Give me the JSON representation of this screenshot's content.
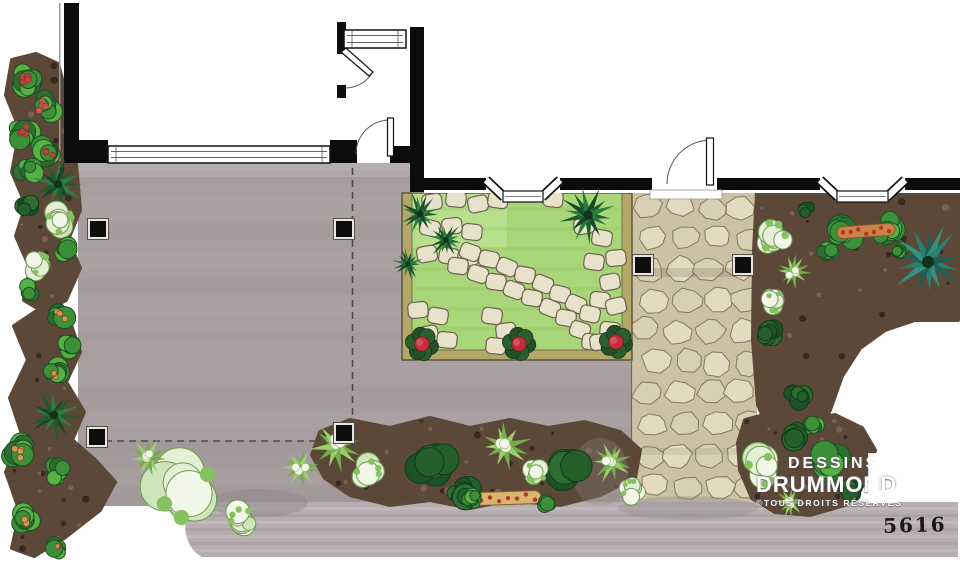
{
  "meta": {
    "plan_number": "5616"
  },
  "branding": {
    "line1": "DESSINS",
    "line2": "DRUMMOND",
    "line3": "©TOUS DROITS RÉSERVÉS",
    "logo_icon": "drummond-d-icon"
  },
  "palette": {
    "wall": "#0c0c0c",
    "patio": "#a79ea0",
    "patioLight": "#c2b9bb",
    "patioDark": "#948b8d",
    "strip": "#b6aeb1",
    "stripLight": "#c8c0c3",
    "stripDark": "#a29a9d",
    "grass": "#a8d678",
    "grassDark": "#8fc45e",
    "grassLight": "#c6e79f",
    "frame": "#b3a76a",
    "frameLine": "#4f4a35",
    "flagBg": "#cdc1a4",
    "flag1": "#e3dac1",
    "flag2": "#d9cfb2",
    "flagLine": "#837860",
    "stone": "#e9e2cb",
    "stoneLine": "#6d6550",
    "mulch": "#5c4838",
    "mulchDark": "#33261d",
    "mulchLight": "#7d6551",
    "g1": "#56b044",
    "g2": "#3b9038",
    "g3": "#2b6e30",
    "gdark": "#1d4e24",
    "shadow": "#8f8689",
    "white": "#ffffff"
  },
  "scene": {
    "patio_path": "M78,163 L412,163 L412,193 L402,193 L402,360 L631,360 L631,506 L78,506 Z",
    "strip_path": "M196,502 Q181,520 187,538 Q191,551 202,557 L958,557 L958,502 Z",
    "flagstone": {
      "x": 632,
      "y": 193,
      "w": 125,
      "h": 313
    },
    "grass": {
      "x": 412,
      "y": 193,
      "w": 210,
      "h": 157
    },
    "mulch_blobs": [
      [
        [
          12,
          60
        ],
        [
          36,
          54
        ],
        [
          58,
          64
        ],
        [
          64,
          86
        ],
        [
          64,
          150
        ],
        [
          76,
          164
        ],
        [
          80,
          210
        ],
        [
          68,
          240
        ],
        [
          80,
          268
        ],
        [
          66,
          300
        ],
        [
          44,
          312
        ],
        [
          24,
          300
        ],
        [
          30,
          268
        ],
        [
          16,
          236
        ],
        [
          26,
          205
        ],
        [
          12,
          172
        ],
        [
          20,
          130
        ],
        [
          6,
          95
        ]
      ],
      [
        [
          44,
          306
        ],
        [
          70,
          322
        ],
        [
          80,
          352
        ],
        [
          66,
          382
        ],
        [
          84,
          412
        ],
        [
          72,
          440
        ],
        [
          95,
          460
        ],
        [
          115,
          482
        ],
        [
          100,
          510
        ],
        [
          64,
          538
        ],
        [
          34,
          556
        ],
        [
          12,
          548
        ],
        [
          20,
          512
        ],
        [
          6,
          472
        ],
        [
          22,
          434
        ],
        [
          10,
          398
        ],
        [
          28,
          360
        ],
        [
          14,
          326
        ]
      ],
      [
        [
          757,
          193
        ],
        [
          958,
          193
        ],
        [
          958,
          320
        ],
        [
          915,
          320
        ],
        [
          885,
          330
        ],
        [
          860,
          348
        ],
        [
          842,
          376
        ],
        [
          830,
          410
        ],
        [
          815,
          440
        ],
        [
          795,
          450
        ],
        [
          772,
          438
        ],
        [
          758,
          405
        ],
        [
          753,
          340
        ],
        [
          754,
          250
        ]
      ],
      [
        [
          320,
          432
        ],
        [
          350,
          420
        ],
        [
          390,
          428
        ],
        [
          430,
          418
        ],
        [
          470,
          428
        ],
        [
          510,
          420
        ],
        [
          548,
          428
        ],
        [
          585,
          422
        ],
        [
          620,
          432
        ],
        [
          640,
          450
        ],
        [
          635,
          478
        ],
        [
          600,
          495
        ],
        [
          560,
          505
        ],
        [
          510,
          500
        ],
        [
          470,
          508
        ],
        [
          430,
          500
        ],
        [
          390,
          505
        ],
        [
          350,
          495
        ],
        [
          325,
          478
        ],
        [
          312,
          455
        ]
      ],
      [
        [
          745,
          420
        ],
        [
          775,
          412
        ],
        [
          805,
          420
        ],
        [
          835,
          415
        ],
        [
          862,
          428
        ],
        [
          875,
          450
        ],
        [
          868,
          480
        ],
        [
          845,
          505
        ],
        [
          810,
          515
        ],
        [
          775,
          512
        ],
        [
          752,
          498
        ],
        [
          740,
          470
        ],
        [
          738,
          443
        ]
      ]
    ],
    "shadows": [
      {
        "x": 258,
        "y": 503,
        "rx": 50,
        "ry": 14,
        "o": 0.45
      },
      {
        "x": 600,
        "y": 472,
        "rx": 28,
        "ry": 34,
        "o": 0.3
      },
      {
        "x": 688,
        "y": 508,
        "rx": 70,
        "ry": 12,
        "o": 0.35
      }
    ],
    "stepping_stones": [
      [
        432,
        202,
        -8
      ],
      [
        456,
        199,
        6
      ],
      [
        478,
        204,
        -12
      ],
      [
        498,
        200,
        8
      ],
      [
        430,
        228,
        14
      ],
      [
        452,
        226,
        -6
      ],
      [
        472,
        232,
        6
      ],
      [
        427,
        254,
        -10
      ],
      [
        449,
        256,
        10
      ],
      [
        468,
        258,
        -4
      ],
      [
        553,
        199,
        6
      ],
      [
        584,
        226,
        -8
      ],
      [
        602,
        238,
        10
      ],
      [
        616,
        258,
        -6
      ],
      [
        594,
        262,
        8
      ],
      [
        610,
        282,
        -10
      ],
      [
        600,
        300,
        6
      ],
      [
        616,
        306,
        -14
      ],
      [
        470,
        252,
        20
      ],
      [
        489,
        259,
        12
      ],
      [
        507,
        267,
        24
      ],
      [
        525,
        275,
        10
      ],
      [
        543,
        284,
        22
      ],
      [
        560,
        294,
        14
      ],
      [
        576,
        304,
        24
      ],
      [
        590,
        314,
        12
      ],
      [
        458,
        266,
        8
      ],
      [
        478,
        274,
        18
      ],
      [
        496,
        282,
        8
      ],
      [
        514,
        290,
        20
      ],
      [
        532,
        298,
        10
      ],
      [
        550,
        308,
        22
      ],
      [
        566,
        318,
        10
      ],
      [
        580,
        330,
        18
      ],
      [
        592,
        342,
        8
      ],
      [
        418,
        310,
        -6
      ],
      [
        438,
        316,
        10
      ],
      [
        428,
        334,
        -12
      ],
      [
        447,
        340,
        6
      ],
      [
        420,
        345,
        -4
      ],
      [
        492,
        316,
        8
      ],
      [
        506,
        331,
        -8
      ],
      [
        496,
        346,
        6
      ],
      [
        610,
        330,
        6
      ],
      [
        600,
        342,
        -6
      ]
    ],
    "dashed_lines": [
      {
        "x1": 352.5,
        "y1": 168,
        "x2": 352.5,
        "y2": 425
      },
      {
        "x1": 105,
        "y1": 441,
        "x2": 336,
        "y2": 441
      }
    ],
    "walls": [
      [
        64,
        3,
        15,
        160
      ],
      [
        64,
        140,
        44,
        23
      ],
      [
        330,
        140,
        27,
        23
      ],
      [
        390,
        146,
        22,
        17
      ],
      [
        337,
        22,
        9,
        32
      ],
      [
        337,
        85,
        9,
        13
      ],
      [
        410,
        27,
        14,
        165
      ],
      [
        424,
        178,
        62,
        12
      ],
      [
        560,
        178,
        92,
        12
      ],
      [
        717,
        178,
        103,
        12
      ],
      [
        905,
        178,
        55,
        12
      ]
    ],
    "windows": [
      {
        "x": 108,
        "y": 146,
        "w": 222,
        "h": 17
      },
      {
        "x": 344,
        "y": 30,
        "w": 62,
        "h": 18
      }
    ],
    "bays": [
      {
        "x1": 486,
        "x2": 560
      },
      {
        "x1": 820,
        "x2": 905
      }
    ],
    "doors": [
      {
        "arc": "M356,154 A34,34 0 0 1 390,120",
        "leaf": [
          387.5,
          118,
          6,
          38
        ]
      },
      {
        "arc": "M345,88 A33,33 0 0 0 371,75",
        "leaf_poly": "M341,52 L346,48 L373,72 L369,76 Z"
      },
      {
        "arc": "M667,184 A44,44 0 0 1 709,140",
        "leaf": [
          706.5,
          138,
          7,
          47
        ],
        "threshold": [
          650,
          190,
          72,
          9
        ]
      }
    ],
    "posts": [
      [
        90,
        221
      ],
      [
        336,
        221
      ],
      [
        89,
        429
      ],
      [
        336,
        425
      ],
      [
        635,
        257
      ],
      [
        735,
        257
      ]
    ],
    "post_size": 16,
    "plants": [
      {
        "t": "shrub",
        "x": 28,
        "y": 80,
        "r": 20,
        "f": "#b5463c"
      },
      {
        "t": "shrub",
        "x": 46,
        "y": 106,
        "r": 19,
        "f": "#c05a50"
      },
      {
        "t": "shrub",
        "x": 22,
        "y": 132,
        "r": 18,
        "f": "#b5463c"
      },
      {
        "t": "shrub",
        "x": 46,
        "y": 152,
        "r": 17,
        "f": "#b5463c"
      },
      {
        "t": "shrub",
        "x": 28,
        "y": 172,
        "r": 15
      },
      {
        "t": "palm",
        "x": 58,
        "y": 184,
        "r": 27
      },
      {
        "t": "shrub-dark",
        "x": 26,
        "y": 206,
        "r": 13
      },
      {
        "t": "varieg",
        "x": 60,
        "y": 220,
        "r": 21
      },
      {
        "t": "shrub",
        "x": 66,
        "y": 252,
        "r": 15
      },
      {
        "t": "varieg",
        "x": 40,
        "y": 264,
        "r": 17
      },
      {
        "t": "shrub",
        "x": 30,
        "y": 292,
        "r": 14
      },
      {
        "t": "shrub",
        "x": 60,
        "y": 314,
        "r": 17,
        "f": "#cf9a4e"
      },
      {
        "t": "shrub",
        "x": 72,
        "y": 346,
        "r": 15
      },
      {
        "t": "shrub",
        "x": 54,
        "y": 374,
        "r": 16,
        "f": "#cf9a4e"
      },
      {
        "t": "palm",
        "x": 54,
        "y": 415,
        "r": 27
      },
      {
        "t": "shrub",
        "x": 20,
        "y": 452,
        "r": 19,
        "f": "#cf9a4e"
      },
      {
        "t": "shrub",
        "x": 58,
        "y": 472,
        "r": 15
      },
      {
        "t": "shrub",
        "x": 24,
        "y": 520,
        "r": 19,
        "f": "#cf9a4e"
      },
      {
        "t": "shrub",
        "x": 58,
        "y": 546,
        "r": 14,
        "f": "#cf9a4e"
      },
      {
        "t": "varieg",
        "x": 188,
        "y": 492,
        "r": 48
      },
      {
        "t": "spiky",
        "x": 148,
        "y": 458,
        "r": 20
      },
      {
        "t": "varieg",
        "x": 242,
        "y": 520,
        "r": 20
      },
      {
        "t": "palm",
        "x": 420,
        "y": 214,
        "r": 22
      },
      {
        "t": "palm",
        "x": 446,
        "y": 240,
        "r": 19
      },
      {
        "t": "palm",
        "x": 408,
        "y": 264,
        "r": 16
      },
      {
        "t": "palm",
        "x": 588,
        "y": 215,
        "r": 30
      },
      {
        "t": "shrub-dark",
        "x": 430,
        "y": 462,
        "r": 30
      },
      {
        "t": "shrub-dark",
        "x": 464,
        "y": 492,
        "r": 20
      },
      {
        "t": "shrub-dark",
        "x": 565,
        "y": 468,
        "r": 26
      },
      {
        "t": "spiky",
        "x": 300,
        "y": 468,
        "r": 20
      },
      {
        "t": "spiky",
        "x": 336,
        "y": 446,
        "r": 26
      },
      {
        "t": "varieg",
        "x": 368,
        "y": 472,
        "r": 20
      },
      {
        "t": "spiky",
        "x": 505,
        "y": 446,
        "r": 26
      },
      {
        "t": "varieg",
        "x": 536,
        "y": 472,
        "r": 17
      },
      {
        "t": "spiky",
        "x": 612,
        "y": 462,
        "r": 22
      },
      {
        "t": "varieg",
        "x": 632,
        "y": 490,
        "r": 16
      },
      {
        "t": "flowerbar",
        "x": 508,
        "y": 498,
        "w": 66,
        "h": 13,
        "rot": -2
      },
      {
        "t": "shrub",
        "x": 474,
        "y": 500,
        "r": 13
      },
      {
        "t": "shrub",
        "x": 548,
        "y": 504,
        "r": 12
      },
      {
        "t": "shrub-dark",
        "x": 806,
        "y": 210,
        "r": 10
      },
      {
        "t": "varieg",
        "x": 772,
        "y": 236,
        "r": 24
      },
      {
        "t": "spiky",
        "x": 793,
        "y": 272,
        "r": 18
      },
      {
        "t": "varieg",
        "x": 776,
        "y": 302,
        "r": 17
      },
      {
        "t": "shrub-dark",
        "x": 766,
        "y": 332,
        "r": 16
      },
      {
        "t": "shrub-dark",
        "x": 798,
        "y": 394,
        "r": 15
      },
      {
        "t": "shrub",
        "x": 812,
        "y": 424,
        "r": 13
      },
      {
        "t": "shrub",
        "x": 845,
        "y": 235,
        "r": 22
      },
      {
        "t": "shrub",
        "x": 886,
        "y": 228,
        "r": 20
      },
      {
        "t": "flowerbar",
        "x": 866,
        "y": 231,
        "w": 58,
        "h": 12,
        "rot": -4,
        "fill": "#c98346"
      },
      {
        "t": "shrub",
        "x": 828,
        "y": 254,
        "r": 13
      },
      {
        "t": "shrub",
        "x": 898,
        "y": 252,
        "r": 12
      },
      {
        "t": "palm",
        "x": 928,
        "y": 262,
        "r": 38,
        "c": "teal"
      },
      {
        "t": "shrub-dark",
        "x": 794,
        "y": 438,
        "r": 18
      },
      {
        "t": "varieg",
        "x": 762,
        "y": 470,
        "r": 26
      },
      {
        "t": "shrub",
        "x": 830,
        "y": 462,
        "r": 21
      },
      {
        "t": "shrub-dark",
        "x": 852,
        "y": 492,
        "r": 15
      },
      {
        "t": "spiky",
        "x": 790,
        "y": 502,
        "r": 16
      },
      {
        "t": "rose",
        "x": 422,
        "y": 344,
        "r": 16
      },
      {
        "t": "rose",
        "x": 519,
        "y": 344,
        "r": 16
      },
      {
        "t": "rose",
        "x": 616,
        "y": 342,
        "r": 16
      }
    ]
  }
}
